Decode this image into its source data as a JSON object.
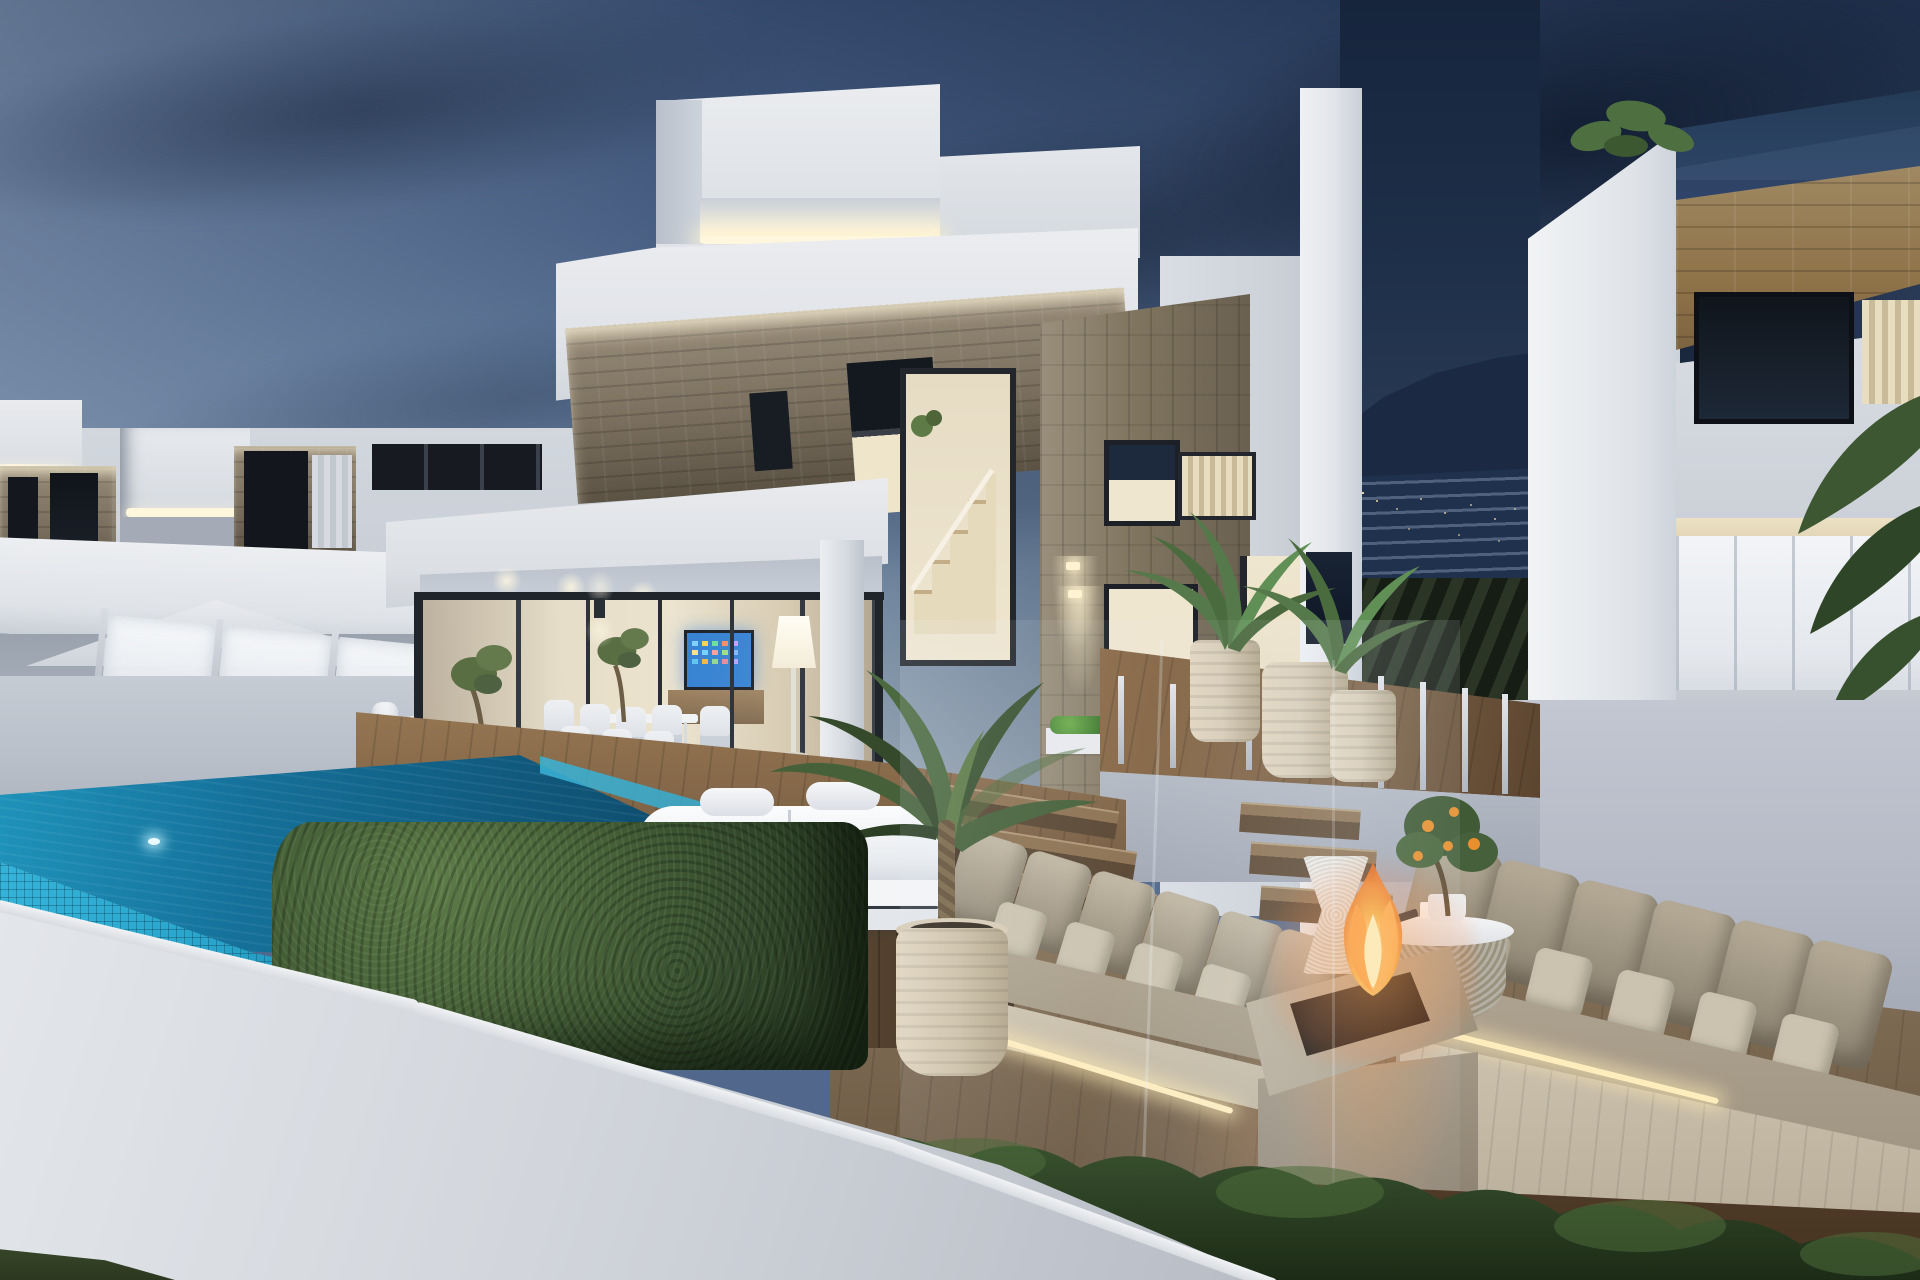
{
  "scene": {
    "description": "Photorealistic 3D architectural rendering of a modern two-storey luxury villa development at dusk, viewed from beside the infinity pool",
    "time_of_day": "dusk",
    "objects": [
      "evening-sky",
      "dark-clouds",
      "hillside-with-apartment-blocks",
      "hillside-lights",
      "left-villa",
      "main-villa",
      "right-villa",
      "rooftop-led-cove-strips",
      "stone-accent-facades",
      "dark-framed-windows",
      "staircase-window",
      "covered-terrace",
      "wall-mounted-tv",
      "glowing-floor-lamp",
      "outdoor-dining-set",
      "olive-trees-in-pots",
      "frosted-glass-balustrade",
      "patio-umbrella",
      "white-lanterns",
      "infinity-pool",
      "pool-mosaic-tiles",
      "underwater-pool-lights",
      "wooden-deck",
      "deck-steps-with-led",
      "white-daybed",
      "sunken-lounge",
      "outdoor-sofa-left",
      "outdoor-sofa-right",
      "seat-cushions",
      "floor-led-strips",
      "concrete-fire-pit",
      "fire-flames",
      "wicker-stool",
      "wicker-coffee-table",
      "citrus-tree",
      "tall-leafy-plant-in-pot",
      "palm-plants-in-pots",
      "trimmed-boxwood-hedge",
      "low-hedge-row",
      "planting-soil",
      "white-perimeter-wall",
      "glass-fence-posts",
      "wood-slat-parapet",
      "navy-glass-parapet"
    ]
  },
  "palette": {
    "skyTop": "#33486b",
    "skyHigh": "#465d82",
    "skyMid": "#5f7899",
    "skyLow": "#8aa0b6",
    "skyHorizon": "#b3c1ce",
    "cloudDark": "#22334e",
    "cloudLight": "#b6c5d4",
    "mountainRock": "#1b2a42",
    "mountainLights": "#ffe2ab",
    "vegetationDark": "#1d2718",
    "whiteLit": "#eef0f3",
    "whiteSoft": "#dfe3e8",
    "whiteShade": "#c3c9d2",
    "whiteDeep": "#9aa2ae",
    "ledWarm": "#fff6de",
    "stoneLight": "#968a77",
    "stoneMid": "#7a6f5e",
    "stoneDark": "#5b5244",
    "frameDark": "#20242b",
    "interiorWarm": "#efe6d0",
    "interiorFloor": "#c5a379",
    "tvScreenBlue": "#2e7ed2",
    "lampGlow": "#fff8e4",
    "poolTileBright": "#2aa6cc",
    "poolEdge": "#1f93ba",
    "poolMid": "#10577a",
    "poolDeep": "#0a3650",
    "deckLight": "#96744f",
    "deckMid": "#7a5f43",
    "deckDark": "#5c4530",
    "loungeFloor": "#7a6750",
    "hedgeLight": "#5d7b47",
    "hedgeMid": "#3f5833",
    "hedgeDark": "#24361e",
    "soilBrown": "#46331f",
    "sofaPillow": "#ccc4b1",
    "sofaFabric": "#b2a793",
    "sofaShadow": "#8f8573",
    "woodBase": "#d2c8b4",
    "potBeige": "#d9cdb8",
    "concreteTop": "#c0b5a2",
    "concreteFront": "#8d8271",
    "fireCore": "#ffe9b0",
    "fireBright": "#ffb347",
    "fireDeep": "#e8641c",
    "umbrellaWhite": "#e8eaee",
    "wallGreyViolet": "#c3c7d2",
    "woodSlats": "#8f7349",
    "glassNavy": "#1d3246"
  }
}
